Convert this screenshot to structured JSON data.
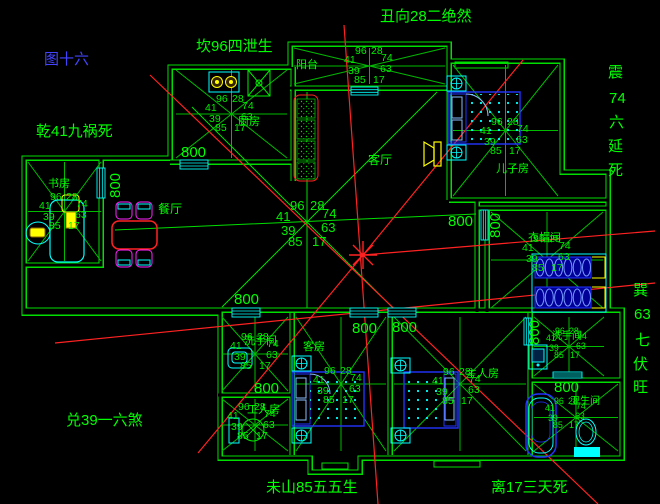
{
  "colors": {
    "background": "#000000",
    "wall_green": "#00dd00",
    "line_green": "#00bb00",
    "annotation_green": "#00ff00",
    "figure_blue": "#4444ff",
    "red": "#ff2222",
    "cyan": "#00ffff",
    "furniture_blue": "#2233ff",
    "yellow": "#ffff00",
    "magenta": "#ff22ff"
  },
  "annotations": {
    "figure_no": {
      "text": "图十六",
      "color": "#4444ff"
    },
    "top": {
      "text": "丑向28二绝然"
    },
    "kan": {
      "text": "坎96四泄生"
    },
    "qian": {
      "text": "乾41九祸死"
    },
    "dui": {
      "text": "兑39一六煞"
    },
    "wei": {
      "text": "未山85五五生"
    },
    "li": {
      "text": "离17三天死"
    },
    "zhen": {
      "text": "震74六延死",
      "segments": [
        "震",
        "74",
        "六",
        "延",
        "死"
      ]
    },
    "xun": {
      "text": "巽63七伏旺",
      "segments": [
        "巽",
        "63",
        "七",
        "伏",
        "旺"
      ]
    }
  },
  "rooms": {
    "balcony": {
      "label": "阳台"
    },
    "living": {
      "label": "客厅"
    },
    "dining": {
      "label": "餐厅"
    },
    "kitchen": {
      "label": "厨房"
    },
    "study": {
      "label": "书房"
    },
    "sons_room": {
      "label": "儿子房"
    },
    "cloakroom": {
      "label": "衣帽间"
    },
    "guest_room": {
      "label": "客房"
    },
    "master_room": {
      "label": "主人房"
    },
    "maid_room": {
      "label": "工人房"
    },
    "washroom_left": {
      "label": "洗手间"
    },
    "washroom_right": {
      "label": "洗手间"
    },
    "bathroom": {
      "label": "卫生间"
    }
  },
  "compass": {
    "n1": "96",
    "n2": "28",
    "w": "41",
    "e": "74",
    "sw": "39",
    "se": "63",
    "s1": "85",
    "s2": "17"
  },
  "dimension_label": "800"
}
